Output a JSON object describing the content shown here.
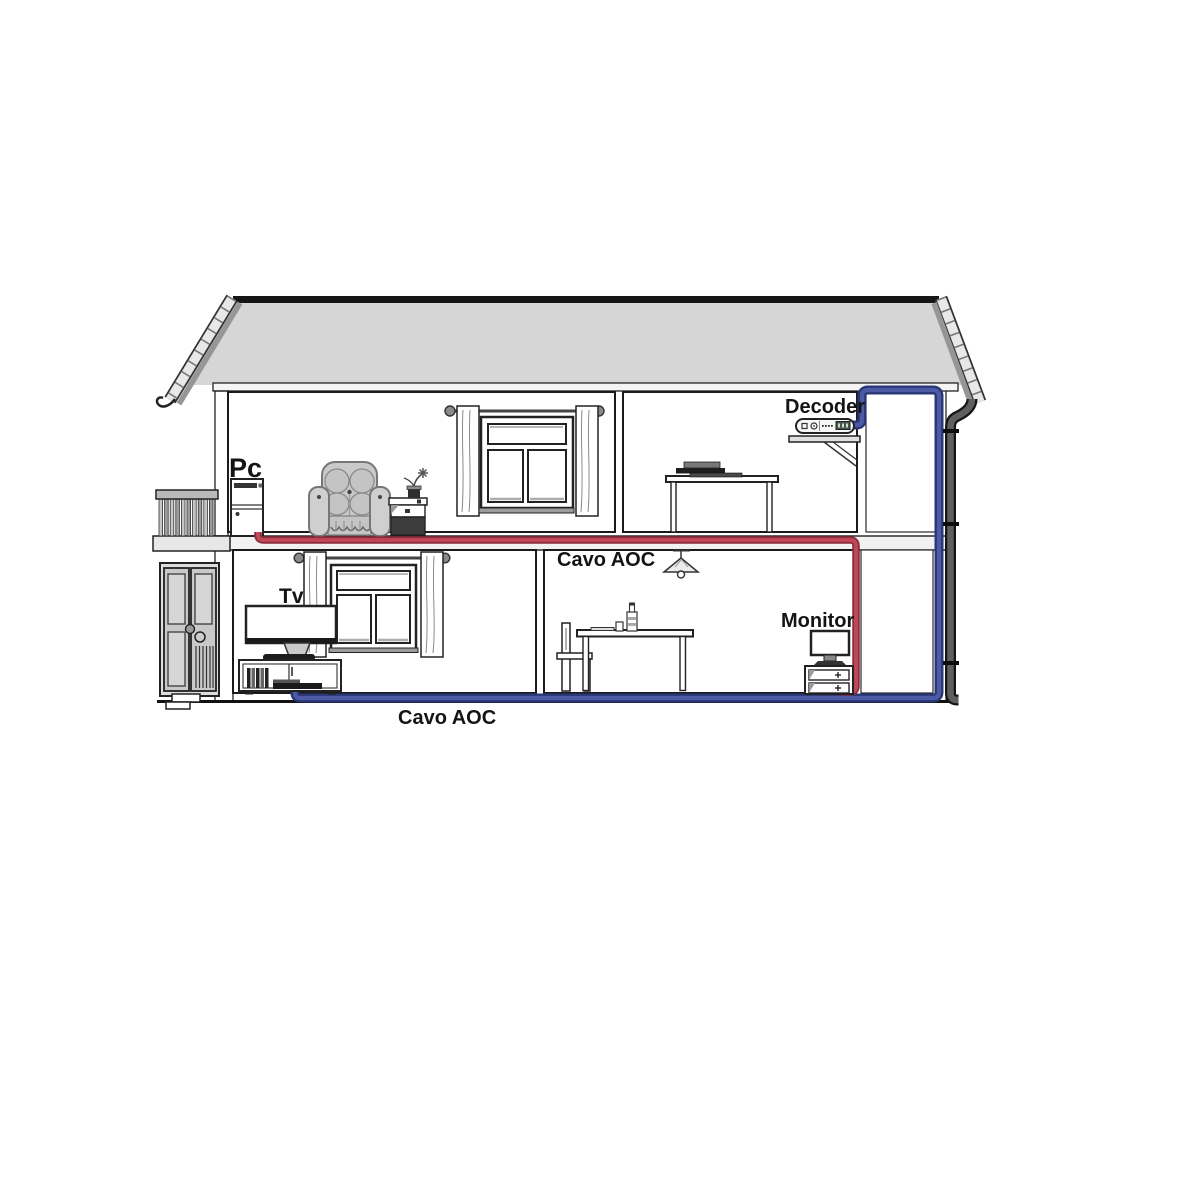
{
  "diagram": {
    "type": "house-cross-section-cable-routing",
    "labels": {
      "pc": "Pc",
      "decoder": "Decoder",
      "tv": "Tv",
      "monitor": "Monitor",
      "cable_label_kitchen": "Cavo AOC",
      "cable_label_bottom": "Cavo AOC"
    },
    "devices": [
      "Pc",
      "Decoder",
      "Tv",
      "Monitor"
    ],
    "cables": [
      {
        "name": "red-aoc-cable",
        "label": "Cavo AOC",
        "from": "Pc",
        "to": "Monitor",
        "color": "#c1485a",
        "outline": "#8c2d39"
      },
      {
        "name": "blue-aoc-cable",
        "label": "Cavo AOC",
        "from": "Decoder",
        "to": "Tv",
        "color": "#4d5aa6",
        "outline": "#2a3776"
      }
    ],
    "colors": {
      "roof_fill": "#d6d6d6",
      "ridge": "#161616",
      "fascia_light": "#e8e8e8",
      "fascia_dark": "#969696",
      "downspout": "#5f5f5f",
      "downspout_outline": "#151515",
      "wall_band": "#f1f1f1"
    }
  }
}
